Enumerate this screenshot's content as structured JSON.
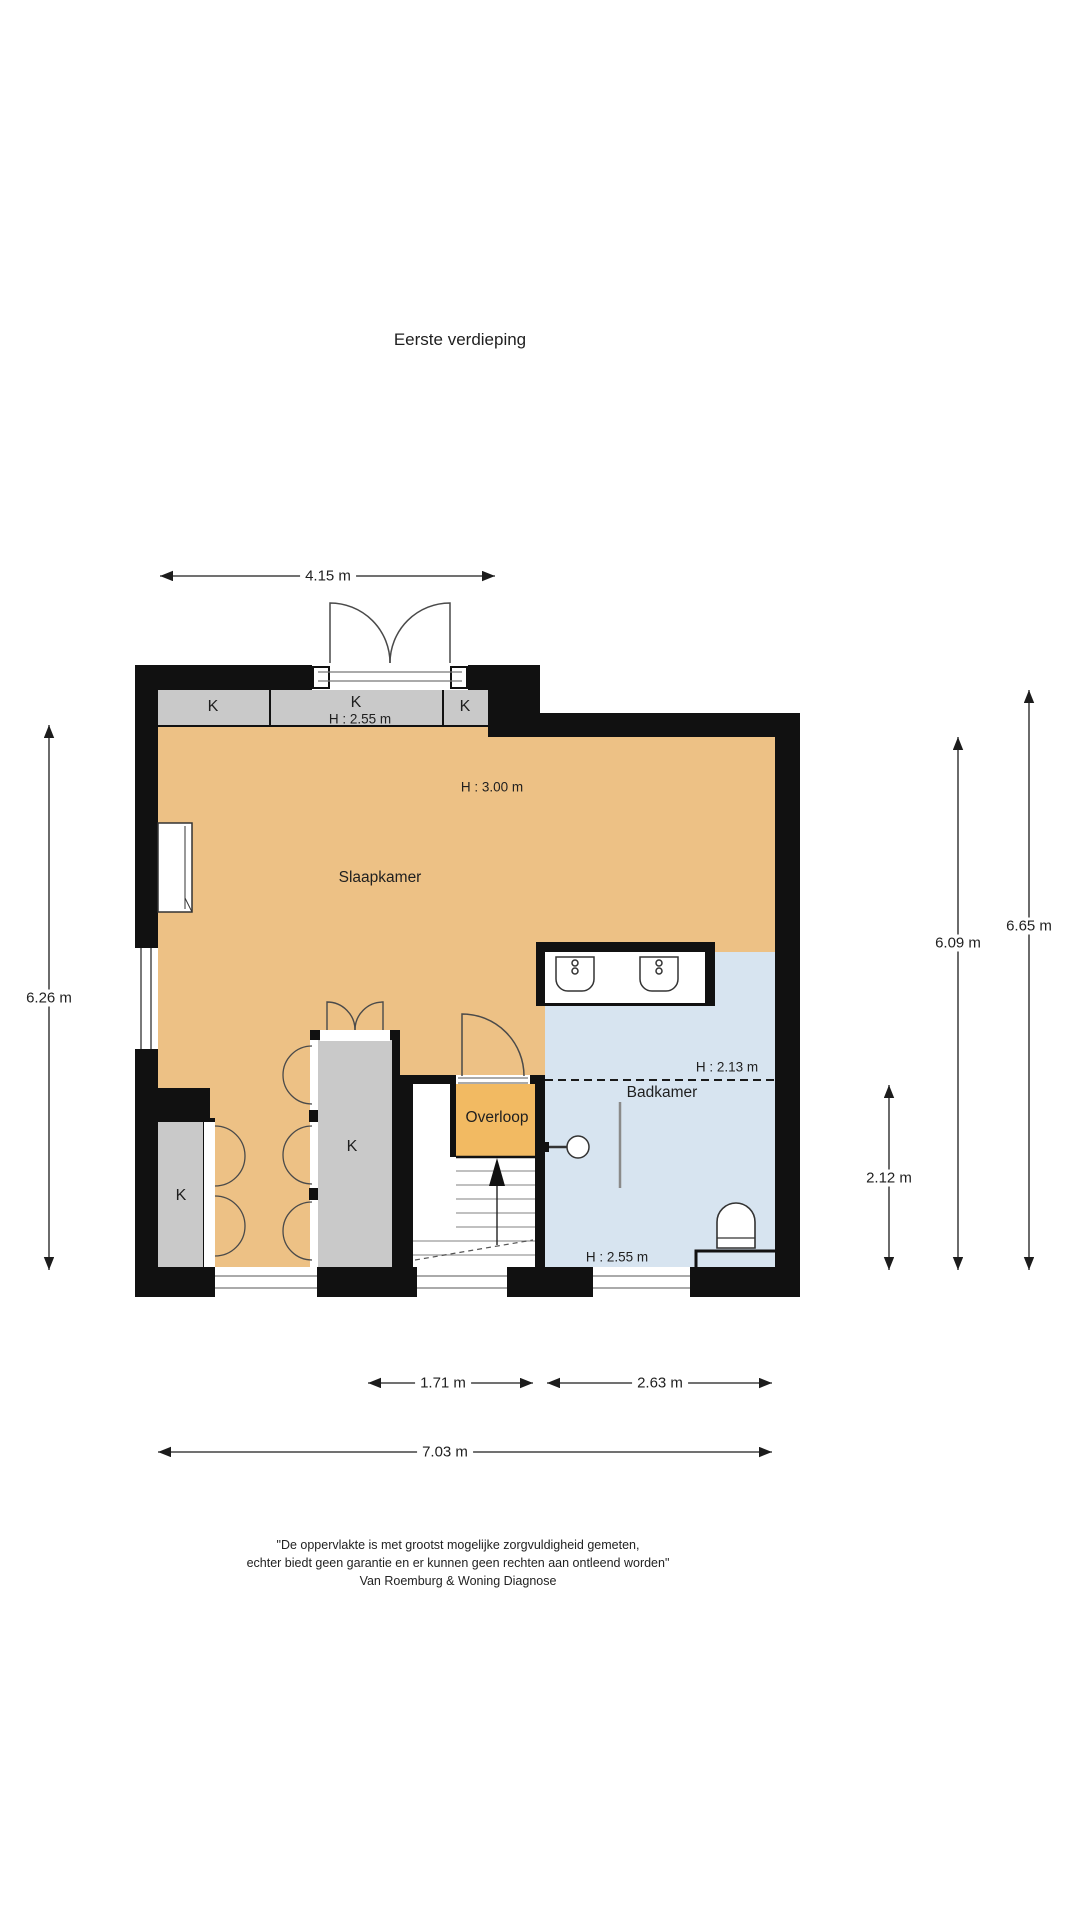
{
  "title": "Eerste verdieping",
  "rooms": {
    "slaapkamer": {
      "label": "Slaapkamer",
      "height": "H : 3.00 m"
    },
    "badkamer": {
      "label": "Badkamer",
      "height_upper": "H : 2.13 m",
      "height_lower": "H : 2.55 m"
    },
    "overloop": {
      "label": "Overloop"
    },
    "closets": {
      "label": "K",
      "height": "H : 2.55 m"
    }
  },
  "dimensions": {
    "top_width": "4.15 m",
    "left_height": "6.26 m",
    "right_inner_height": "6.09 m",
    "right_outer_height": "6.65 m",
    "right_lower_height": "2.12 m",
    "bottom_stair_width": "1.71 m",
    "bottom_badkamer_width": "2.63 m",
    "bottom_total_width": "7.03 m"
  },
  "disclaimer": [
    "\"De oppervlakte is met grootst mogelijke zorgvuldigheid gemeten,",
    "echter biedt geen garantie en er kunnen geen rechten aan ontleend worden\"",
    "Van Roemburg & Woning Diagnose"
  ],
  "colors": {
    "room_orange": "#edc185",
    "overloop_orange": "#f2ba62",
    "closet_gray": "#c9c9c9",
    "bathroom_blue": "#d7e4f0",
    "wall_black": "#111111"
  }
}
